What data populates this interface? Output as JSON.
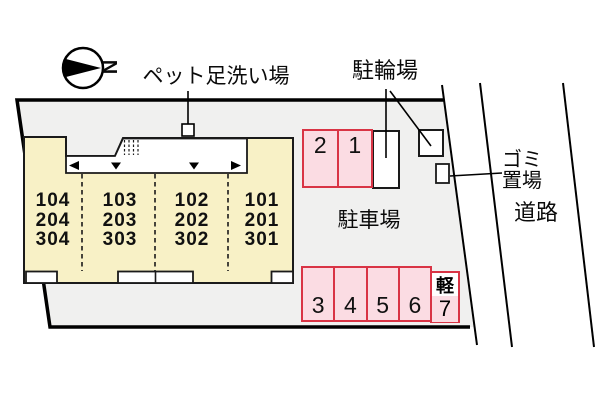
{
  "compass": {
    "north_label": "N"
  },
  "labels": {
    "pet_wash_station": "ペット足洗い場",
    "bicycle_parking": "駐輪場",
    "garbage_area": "ゴミ\n置場",
    "road": "道路",
    "parking_lot": "駐車場"
  },
  "building": {
    "units": [
      {
        "stack": [
          "104",
          "204",
          "304"
        ]
      },
      {
        "stack": [
          "103",
          "203",
          "303"
        ]
      },
      {
        "stack": [
          "102",
          "202",
          "302"
        ]
      },
      {
        "stack": [
          "101",
          "201",
          "301"
        ]
      }
    ]
  },
  "parking": {
    "top_row": [
      "2",
      "1"
    ],
    "bottom_row": [
      "3",
      "4",
      "5",
      "6"
    ],
    "kei_space": {
      "tag": "軽",
      "number": "7"
    }
  },
  "icons": {
    "north_arrow": "compass-north-arrow",
    "entrance_arrows": [
      "left",
      "down",
      "down",
      "right"
    ]
  },
  "colors": {
    "site_fill": "#f0f0ef",
    "building_fill": "#f8f1c6",
    "parking_space_fill": "#fbdce3",
    "parking_space_border": "#d93445",
    "line": "#000000"
  }
}
